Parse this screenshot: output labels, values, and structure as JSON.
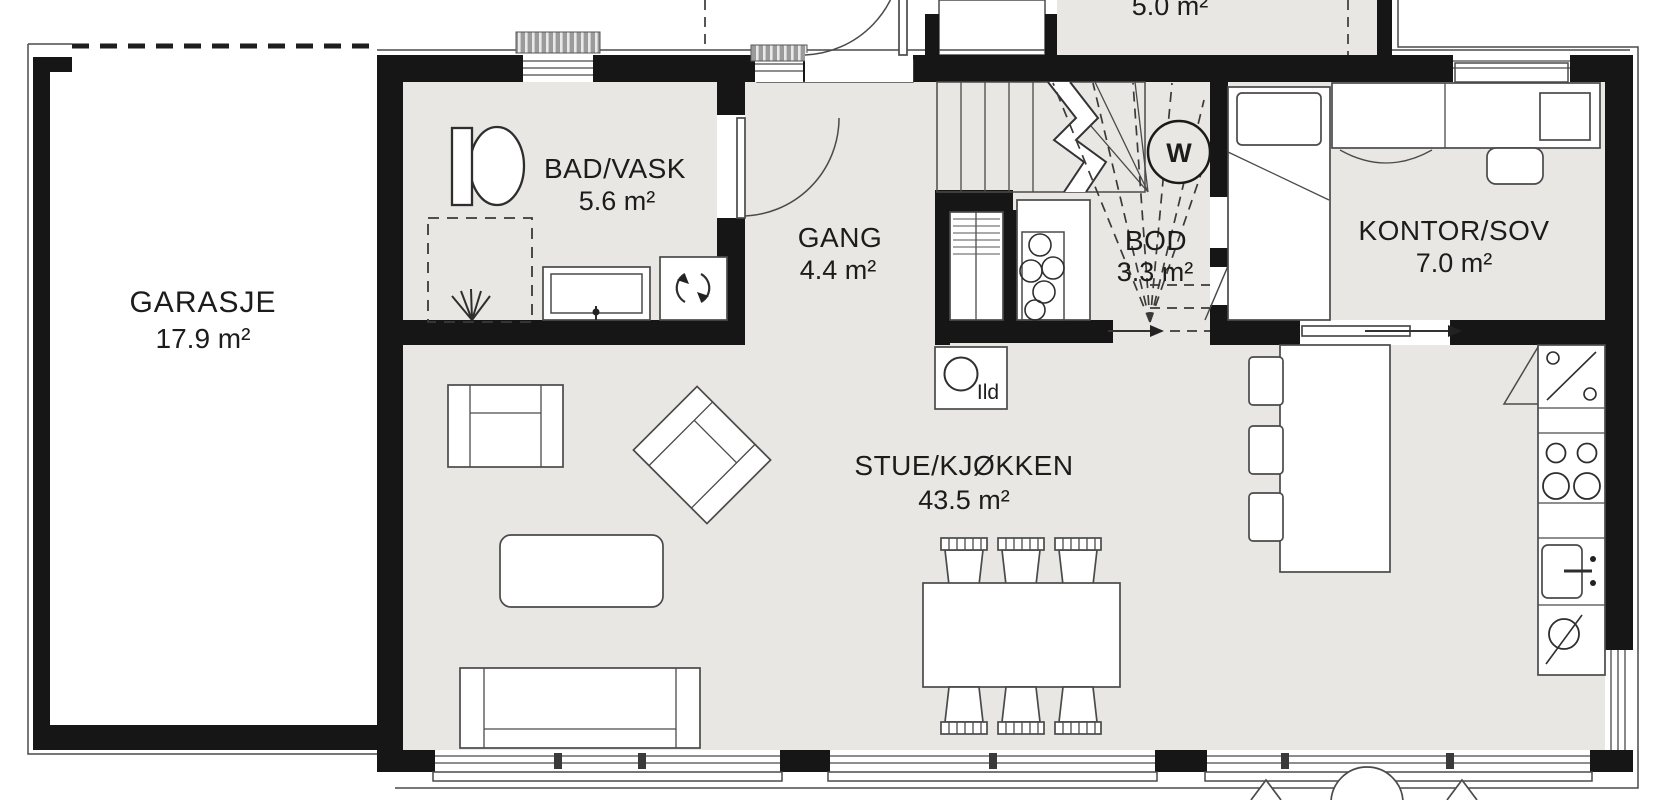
{
  "floorplan": {
    "rooms": {
      "garage": {
        "name": "GARASJE",
        "area": "17.9 m²"
      },
      "bathroom": {
        "name": "BAD/VASK",
        "area": "5.6 m²"
      },
      "hallway": {
        "name": "GANG",
        "area": "4.4 m²"
      },
      "storage": {
        "name": "BOD",
        "area": "3.3 m²"
      },
      "office": {
        "name": "KONTOR/SOV",
        "area": "7.0 m²"
      },
      "living": {
        "name": "STUE/KJØKKEN",
        "area": "43.5 m²"
      },
      "porch": {
        "area": "5.0 m²"
      }
    },
    "annotations": {
      "fireplace": "Ild",
      "water_heater": "W"
    },
    "colors": {
      "wall": "#161616",
      "floor": "#e9e7e3",
      "line": "#4a4a4a",
      "background": "#ffffff"
    }
  }
}
